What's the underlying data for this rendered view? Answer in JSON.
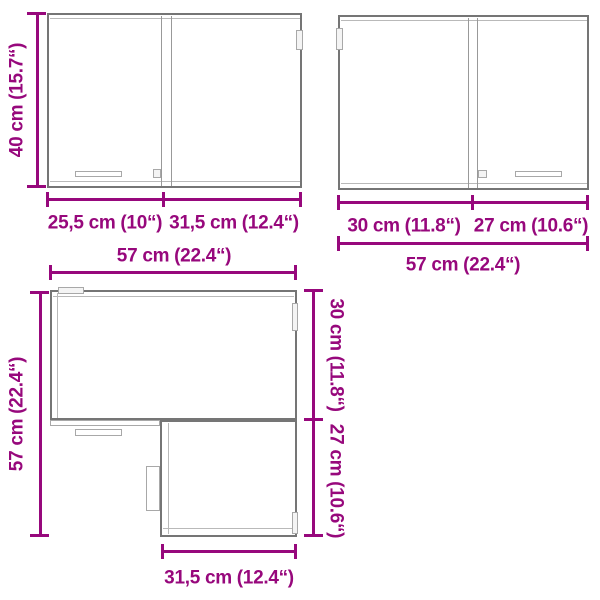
{
  "figure": {
    "colors": {
      "dimension": "#97087c",
      "cabinet_outline": "#757575",
      "cabinet_detail": "#b9b9b9",
      "background": "#ffffff"
    },
    "front_view_left": {
      "height": "40 cm (15.7“)",
      "left_door_width": "25,5 cm (10“)",
      "right_door_width": "31,5 cm (12.4“)"
    },
    "front_view_right": {
      "left_door_width": "30 cm (11.8“)",
      "right_door_width": "27 cm (10.6“)",
      "total_width": "57 cm (22.4“)"
    },
    "corner_view": {
      "top_width": "57 cm (22.4“)",
      "left_depth": "57 cm (22.4“)",
      "right_upper_depth": "30 cm (11.8“)",
      "right_lower_depth": "27 cm (10.6“)",
      "bottom_width": "31,5 cm (12.4“)"
    }
  }
}
